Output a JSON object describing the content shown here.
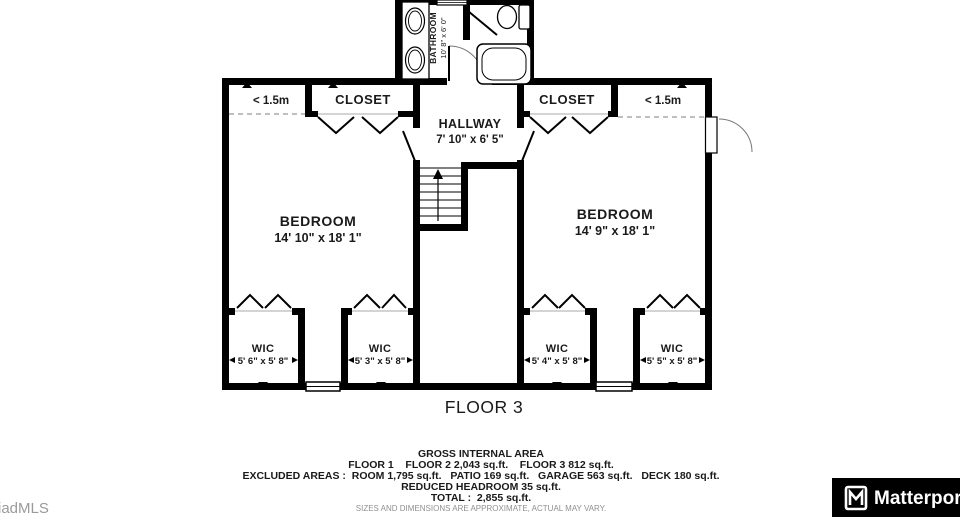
{
  "floor_title": "FLOOR 3",
  "rooms": {
    "bathroom": {
      "name": "BATHROOM",
      "dims": "10' 8\" x 6' 0\""
    },
    "hallway": {
      "name": "HALLWAY",
      "dims": "7' 10\" x 6' 5\""
    },
    "closet_left": {
      "name": "CLOSET"
    },
    "closet_right": {
      "name": "CLOSET"
    },
    "bedroom_left": {
      "name": "BEDROOM",
      "dims": "14' 10\" x 18' 1\""
    },
    "bedroom_right": {
      "name": "BEDROOM",
      "dims": "14' 9\" x 18' 1\""
    },
    "wic_1": {
      "name": "WIC",
      "dims": "5' 6\" x 5' 8\""
    },
    "wic_2": {
      "name": "WIC",
      "dims": "5' 3\" x 5' 8\""
    },
    "wic_3": {
      "name": "WIC",
      "dims": "5' 4\" x 5' 8\""
    },
    "wic_4": {
      "name": "WIC",
      "dims": "5' 5\" x 5' 8\""
    }
  },
  "headroom": {
    "left": "< 1.5m",
    "right": "< 1.5m"
  },
  "footer": {
    "title": "GROSS INTERNAL AREA",
    "line_floors": "FLOOR 1    FLOOR 2 2,043 sq.ft.    FLOOR 3 812 sq.ft.",
    "line_excluded": "EXCLUDED AREAS :  ROOM 1,795 sq.ft.   PATIO 169 sq.ft.   GARAGE 563 sq.ft.   DECK 180 sq.ft.",
    "line_reduced": "REDUCED HEADROOM 35 sq.ft.",
    "line_total": "TOTAL :  2,855 sq.ft.",
    "disclaimer": "SIZES AND DIMENSIONS ARE APPROXIMATE, ACTUAL MAY VARY."
  },
  "watermark": "iadMLS",
  "branding": {
    "logo_text": "Matterport",
    "logo_icon": "matterport-m-icon"
  },
  "colors": {
    "wall": "#000000",
    "dashed_line": "#999999",
    "door_arc": "#666666",
    "muted_text": "#9a9a9a",
    "brand_bg": "#000000",
    "brand_text": "#ffffff"
  }
}
